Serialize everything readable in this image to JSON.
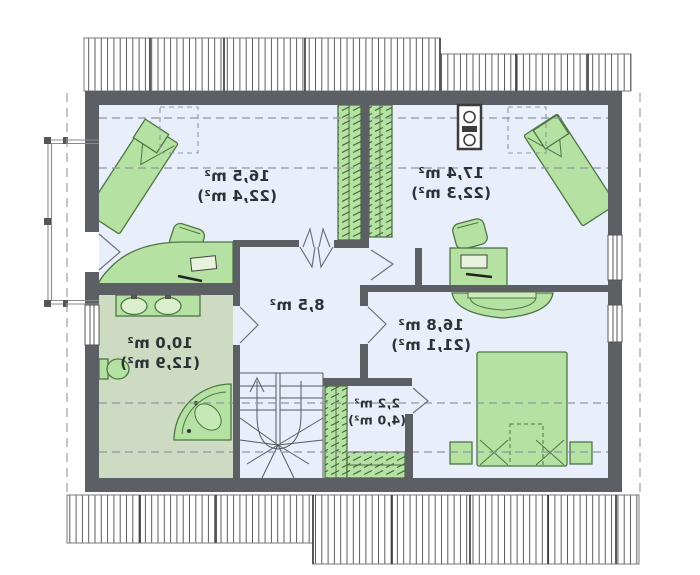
{
  "plan": {
    "type": "attic-floor-plan",
    "mirrored": true,
    "rooms": [
      {
        "name": "room-top-left",
        "area": "16,5 m²",
        "area_gross": "(22,4 m²)",
        "furniture": [
          "bed-icon",
          "nightstand-icon",
          "pouf-icon",
          "desk-icon",
          "laptop-icon",
          "skylight-dashed-box"
        ]
      },
      {
        "name": "room-top-right",
        "area": "17,4 m²",
        "area_gross": "(22,3 m²)",
        "furniture": [
          "bed-icon",
          "nightstand-icon",
          "pouf-icon",
          "desk-icon",
          "laptop-icon",
          "wardrobe-icon",
          "chimney-icon",
          "skylight-dashed-box"
        ]
      },
      {
        "name": "hall",
        "area": "8,5 m²",
        "area_gross": "",
        "furniture": [
          "stairs-icon"
        ]
      },
      {
        "name": "bathroom",
        "area": "10,0 m²",
        "area_gross": "(12,9 m²)",
        "furniture": [
          "double-sink-icon",
          "toilet-icon",
          "corner-bathtub-icon"
        ]
      },
      {
        "name": "bedroom",
        "area": "16,8 m²",
        "area_gross": "(21,1 m²)",
        "furniture": [
          "double-bed-icon",
          "nightstand-icon",
          "nightstand-icon",
          "half-round-table-icon"
        ]
      },
      {
        "name": "closet",
        "area": "2,2 m²",
        "area_gross": "(4,0 m²)",
        "furniture": [
          "shelving-icon"
        ]
      }
    ],
    "colors": {
      "wall": "#5c6065",
      "room_floor": "#e9effa",
      "bathroom_floor": "#ccdbc1",
      "furniture_fill": "#b5e2a2",
      "furniture_border": "#4e7544",
      "roof_hatch_line": "#4b4b4b",
      "dashed_guide": "#8f97a1",
      "text": "#2e3135"
    }
  }
}
